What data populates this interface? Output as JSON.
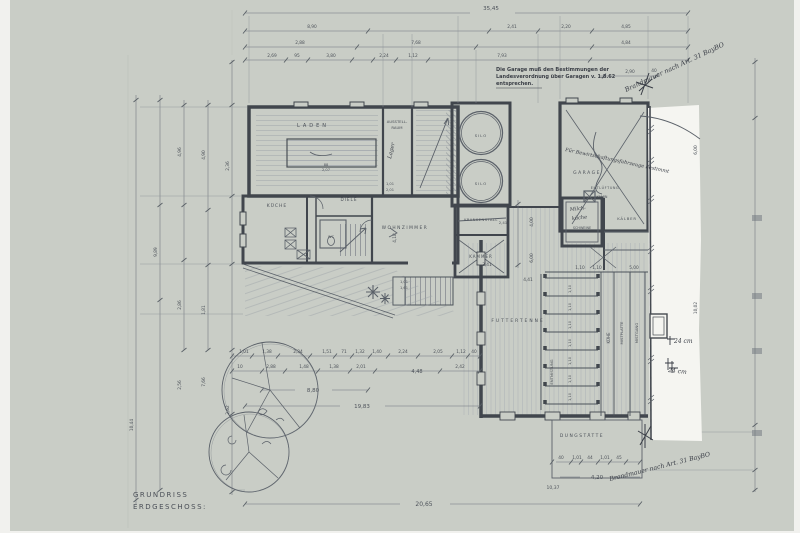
{
  "document": {
    "title_line1": "GRUNDRISS",
    "title_line2": "ERDGESCHOSS:",
    "garage_note_1": "Die Garage muß den Bestimmungen der",
    "garage_note_2": "Landesverordnung über Garagen v. 1.8.62",
    "garage_note_3": "entsprechen.",
    "brandmauer_top": "Brandmauer nach Art. 31 BayBO",
    "brandmauer_bottom": "Brandmauer nach Art. 31 BayBO",
    "garage_use_note": "Für Bewirtschaftungsfahrzeuge bestimmt",
    "lager_note": "Lager",
    "milk_note_1": "Milch-",
    "milk_note_2": "küche",
    "wall_note_1": "24 cm",
    "wall_note_2": "24 cm"
  },
  "rooms": {
    "laden": "LADEN",
    "ausstellraum1": "AUSSTELL-",
    "ausstellraum2": "RAUM",
    "kueche": "KÜCHE",
    "diele": "DIELE",
    "wc": "WC",
    "wohnzimmer": "WOHNZIMMER",
    "krankenstall": "KRANKENSTALL",
    "kammer": "KAMMER",
    "silo1": "SILO",
    "silo2": "SILO",
    "garage": "GARAGE",
    "schweine": "SCHWEINE",
    "kaelber": "KÄLBER",
    "kamin": "KAMIN",
    "entlueftung": "ENTLÜFTUNG",
    "futtertenne": "FUTTERTENNE",
    "kuehe": "KÜHE",
    "mistplatte": "MISTPLATTE",
    "mistgang": "MISTGANG",
    "entmistung": "ENTMISTUNG",
    "dungstaette": "DUNGSTÄTTE"
  },
  "dimensions": {
    "overall_top": "35,45",
    "overall_bottom": "20,65",
    "front_width": "8,80",
    "right_total": "19,83",
    "dung_width": "4,20",
    "stair_width": "4,48"
  },
  "dim_labels": [
    [
      "8,90",
      312,
      28
    ],
    [
      "2,41",
      512,
      28
    ],
    [
      "2,20",
      566,
      28
    ],
    [
      "4,85",
      626,
      28
    ],
    [
      "2,88",
      300,
      44
    ],
    [
      "7,68",
      416,
      44
    ],
    [
      "4,84",
      626,
      44
    ],
    [
      "2,69",
      272,
      57
    ],
    [
      "95",
      297,
      57
    ],
    [
      "3,80",
      331,
      57
    ],
    [
      "2,24",
      384,
      57
    ],
    [
      "1,12",
      413,
      57
    ],
    [
      "7,93",
      502,
      57
    ],
    [
      "2,90",
      630,
      73
    ],
    [
      "40",
      654,
      72
    ],
    [
      "4,96",
      181,
      152,
      -90
    ],
    [
      "4,90",
      205,
      155,
      -90
    ],
    [
      "2,36",
      229,
      166,
      -90
    ],
    [
      "9,89",
      157,
      252,
      -90
    ],
    [
      "2,86",
      181,
      305,
      -90
    ],
    [
      "1,81",
      205,
      310,
      -90
    ],
    [
      "2,56",
      181,
      385,
      -90
    ],
    [
      "7,66",
      205,
      382,
      -90
    ],
    [
      "2,62",
      229,
      410,
      -90
    ],
    [
      "10,44",
      133,
      425,
      -90
    ],
    [
      "88",
      326,
      166,
      0,
      3.6
    ],
    [
      "2,07",
      326,
      171,
      0,
      3.6
    ],
    [
      "1,01",
      390,
      185,
      0,
      3.6
    ],
    [
      "2,01",
      390,
      191,
      0,
      3.6
    ],
    [
      "4,18",
      396,
      238,
      -90
    ],
    [
      "3,41",
      487,
      266
    ],
    [
      "2,41",
      503,
      224,
      0,
      3.8
    ],
    [
      "4,00",
      533,
      222,
      -90
    ],
    [
      "6,00",
      533,
      258,
      -90
    ],
    [
      "1,01",
      404,
      283,
      0,
      3.6
    ],
    [
      "1,61",
      404,
      289,
      0,
      3.6
    ],
    [
      "4,41",
      528,
      281
    ],
    [
      "1,10",
      580,
      269
    ],
    [
      "1,10",
      597,
      269
    ],
    [
      "5,00",
      634,
      269
    ],
    [
      "1,10",
      571,
      289,
      -90,
      3.6
    ],
    [
      "1,10",
      571,
      307,
      -90,
      3.6
    ],
    [
      "1,10",
      571,
      325,
      -90,
      3.6
    ],
    [
      "1,10",
      571,
      343,
      -90,
      3.6
    ],
    [
      "1,10",
      571,
      361,
      -90,
      3.6
    ],
    [
      "1,10",
      571,
      379,
      -90,
      3.6
    ],
    [
      "1,10",
      571,
      397,
      -90,
      3.6
    ],
    [
      "1,01",
      244,
      353
    ],
    [
      "1,38",
      267,
      353
    ],
    [
      "2,34",
      298,
      353
    ],
    [
      "1,51",
      327,
      353
    ],
    [
      "71",
      344,
      353
    ],
    [
      "1,32",
      360,
      353
    ],
    [
      "1,40",
      377,
      353
    ],
    [
      "2,24",
      403,
      353
    ],
    [
      "2,05",
      438,
      353
    ],
    [
      "1,12",
      461,
      353
    ],
    [
      "40",
      474,
      353
    ],
    [
      "10",
      240,
      368
    ],
    [
      "2,88",
      271,
      368
    ],
    [
      "1,48",
      304,
      368
    ],
    [
      "1,38",
      334,
      368
    ],
    [
      "2,01",
      361,
      368
    ],
    [
      "2,42",
      460,
      368
    ],
    [
      "40",
      561,
      459
    ],
    [
      "1,01",
      577,
      459
    ],
    [
      "44",
      590,
      459
    ],
    [
      "1,01",
      605,
      459
    ],
    [
      "45",
      619,
      459
    ],
    [
      "10,37",
      553,
      489,
      0,
      4.5
    ],
    [
      "6,00",
      697,
      150,
      -90
    ],
    [
      "10,02",
      697,
      308,
      -90
    ]
  ],
  "colors": {
    "paper": "#c9cdc6",
    "line": "#6e747c",
    "wall": "#41464d",
    "ink": "#383c45",
    "white_strip": "#f5f5f1"
  }
}
